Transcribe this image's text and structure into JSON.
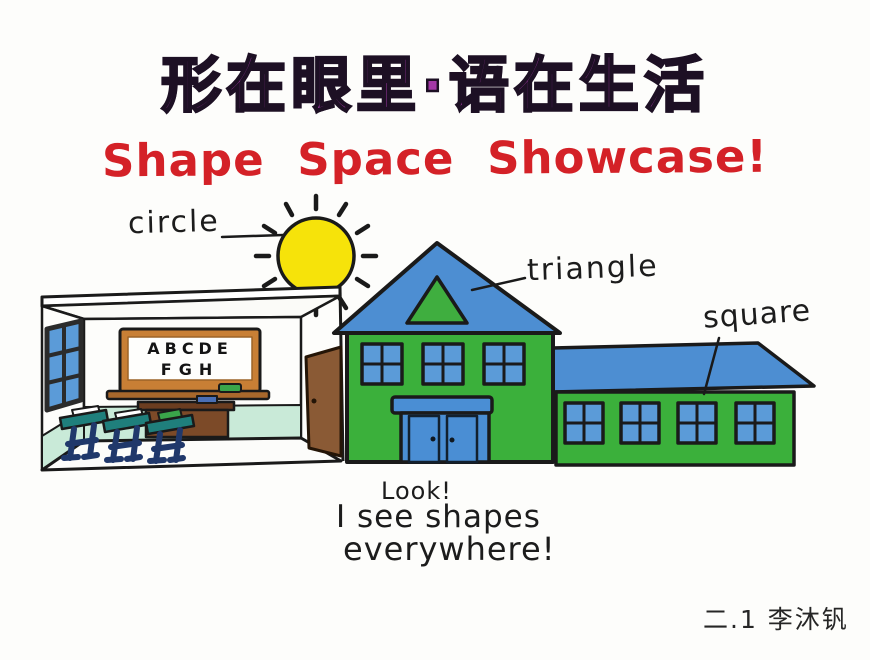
{
  "poster": {
    "title_zh": "形在眼里·语在生活",
    "title_en": "Shape Space Showcase!",
    "shape_labels": {
      "circle": "circle",
      "triangle": "triangle",
      "square": "square"
    },
    "blackboard": {
      "line1": "ABCDE",
      "line2": "FGH"
    },
    "caption": {
      "line1": "Look!",
      "line2": "I see shapes",
      "line3": "everywhere!"
    },
    "signature": "二.1 李沐钒",
    "colors": {
      "title_purple": "#a338a6",
      "title_red": "#d42127",
      "sun_yellow": "#f6e30a",
      "roof_blue": "#4d8ed2",
      "wall_green": "#3bb03b",
      "vent_green": "#3fae3f",
      "window_blue": "#5b9bd8",
      "door_blue": "#4a8ed4",
      "mint": "#c9ead8",
      "desk_teal": "#1f7f7c",
      "leg_navy": "#20386b",
      "door_brown": "#8a5a35",
      "board_frame": "#c87f35",
      "ledge_brown": "#a8682c",
      "teacher_desk_brown": "#7c4a28",
      "book_green": "#3aa54a",
      "chalk_blue": "#4a6fb5",
      "ink": "#1a1a1a"
    }
  }
}
